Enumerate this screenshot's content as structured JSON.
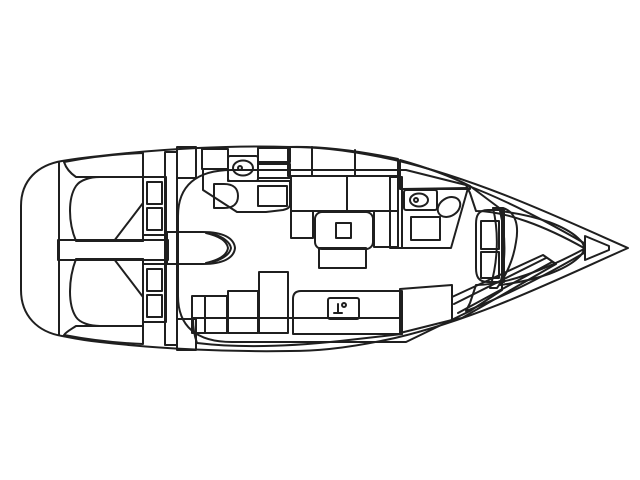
{
  "diagram": {
    "type": "sailboat-interior-floorplan",
    "orientation": "bow-right",
    "palette": {
      "outline": "#1f1f1f",
      "paper": "#ffffff",
      "deck": "#c8c8c8",
      "floor": "#f2e3a7",
      "bed": "#f4b077",
      "upholstery": "#cdb2a4",
      "table": "#9a6f4e",
      "table_inset": "#a87f5a",
      "wet": "#cfdde8",
      "fixture": "#ffffff",
      "sink_counter": "#d6d6d6",
      "ink": "#111111"
    }
  }
}
